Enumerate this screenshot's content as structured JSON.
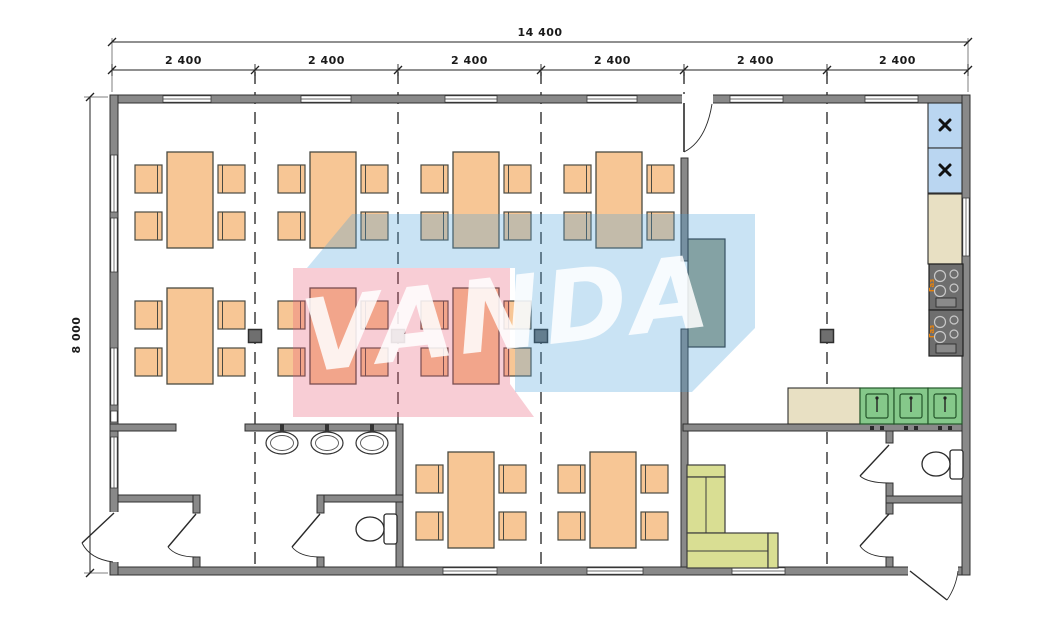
{
  "plan": {
    "title": "modular-building-floor-plan",
    "dimensions": {
      "total_width_label": "14 400",
      "segment_labels": [
        "2 400",
        "2 400",
        "2 400",
        "2 400",
        "2 400",
        "2 400"
      ],
      "height_label": "8 000"
    },
    "watermark": {
      "text": "VANDA",
      "pink_color": "rgba(232,88,115,0.30)",
      "blue_color": "rgba(75,162,218,0.30)",
      "letter_color": "rgba(255,255,255,0.85)"
    },
    "kitchen": {
      "stove_label": "Газ"
    },
    "inventory": {
      "dining_tables": 9,
      "chairs": 36,
      "washbasins": 3,
      "toilets": 2,
      "kitchen_sinks": 3,
      "refrigerators": 2,
      "stoves": 2,
      "corner_sofas": 1,
      "serving_counters": 1
    },
    "colors": {
      "wall": "#898989",
      "furniture_orange": "#F7C695",
      "fridge_blue": "#BAD6F1",
      "counter_beige": "#E8E0C3",
      "sink_green": "#85C88A",
      "sofa_green": "#D9DE93",
      "stove_gray": "#6E6E6E",
      "serving_counter_sage": "#9CA28D",
      "stove_symbol_orange": "#E8820C"
    }
  }
}
